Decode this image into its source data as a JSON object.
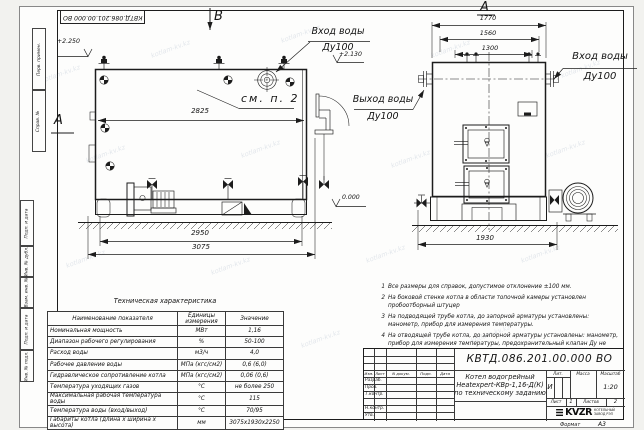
{
  "stamp": {
    "text": "КВТД.086.201.00.000  ВО"
  },
  "watermark": {
    "text": "kotlam-kv.kz"
  },
  "frame_labels": {
    "perv_primen": "Перв. примен.",
    "sprav_no": "Справ. №",
    "podp_data1": "Подп. и дата",
    "inv_dubl": "Инв. № дубл.",
    "vzam_inv": "Взам. инв. №",
    "podp_data2": "Подп. и дата",
    "inv_podl": "Инв. № подл."
  },
  "views": {
    "side": {
      "label_b": "В",
      "label_a": "А",
      "elev_top": "+2.250",
      "elev_mid": "+2.130",
      "elev_zero": "0.000",
      "note_ref": "см. п. 2",
      "dim_2825": "2825",
      "dim_2950": "2950",
      "dim_3075": "3075",
      "inlet_line1": "Вход воды",
      "inlet_line2": "Ду100",
      "outlet_line1": "Выход воды",
      "outlet_line2": "Ду100"
    },
    "front": {
      "label_a": "А",
      "dim_1770": "1770",
      "dim_1560": "1560",
      "dim_1300": "1300",
      "dim_1930": "1930",
      "inlet_line1": "Вход воды",
      "inlet_line2": "Ду100"
    }
  },
  "tech_table": {
    "title": "Техническая характеристика",
    "headers": [
      "Наименование показателя",
      "Единицы измерения",
      "Значение"
    ],
    "rows": [
      [
        "Номинальная мощность",
        "МВт",
        "1,16"
      ],
      [
        "Диапазон рабочего регулирования",
        "%",
        "50-100"
      ],
      [
        "Расход воды",
        "м3/ч",
        "4,0"
      ],
      [
        "Рабочее давление воды",
        "МПа (кгс/см2)",
        "0,6 (6,0)"
      ],
      [
        "Гидравлическое сопротивление котла",
        "МПа (кгс/см2)",
        "0,06 (0,6)"
      ],
      [
        "Температура уходящих газов",
        "°С",
        "не более 250"
      ],
      [
        "Максимальная рабочая температура воды",
        "°С",
        "115"
      ],
      [
        "Температура воды (вход/выход)",
        "°С",
        "70/95"
      ],
      [
        "Габариты котла (длина х ширина х высота)",
        "мм",
        "3075х1930х2250"
      ]
    ]
  },
  "notes": {
    "items": [
      {
        "num": "1",
        "text": "Все размеры для справок, допустимое отклонение ±100 мм."
      },
      {
        "num": "2",
        "text": "На боковой стенке котла в области топочной камеры установлен пробоотборный штуцер"
      },
      {
        "num": "3",
        "text": "На подводящей трубе котла, до запорной арматуры установлены: манометр, прибор для измерения температуры."
      },
      {
        "num": "4",
        "text": "На отводящей трубе котла, до запорной арматуры установлены: манометр, прибор для измерения температуры, предохранительный клапан Ду не менее 50 мм и обвод с обратным клапаном Ду не менее 50 мм."
      }
    ]
  },
  "title_block": {
    "doc_number": "КВТД.086.201.00.000  ВО",
    "col_izm": "Изм.",
    "col_list": "Лист",
    "col_doc": "N докум.",
    "col_podp": "Подп.",
    "col_data": "Дата",
    "row_razrab": "Разраб.",
    "row_prov": "Пров.",
    "row_tkontr": "Т.контр.",
    "row_nkontr": "Н.контр.",
    "row_utv": "Утв.",
    "title_line1": "Котел водогрейный",
    "title_line2": "Heatexpert-КВр-1,16-Д(К)",
    "title_line3": "по техническому заданию",
    "lit_label": "Лит.",
    "lit_value": "И",
    "massa_label": "Масса",
    "masshtab_label": "Масштаб",
    "masshtab_value": "1:20",
    "list_label": "Лист",
    "list_value": "1",
    "listov_label": "Листов",
    "listov_value": "2",
    "company_logo": "KVZR",
    "company_name1": "КОТЕЛЬНЫЙ",
    "company_name2": "ЗАВОД РЭП"
  },
  "format": {
    "label": "Формат",
    "value": "А3"
  }
}
